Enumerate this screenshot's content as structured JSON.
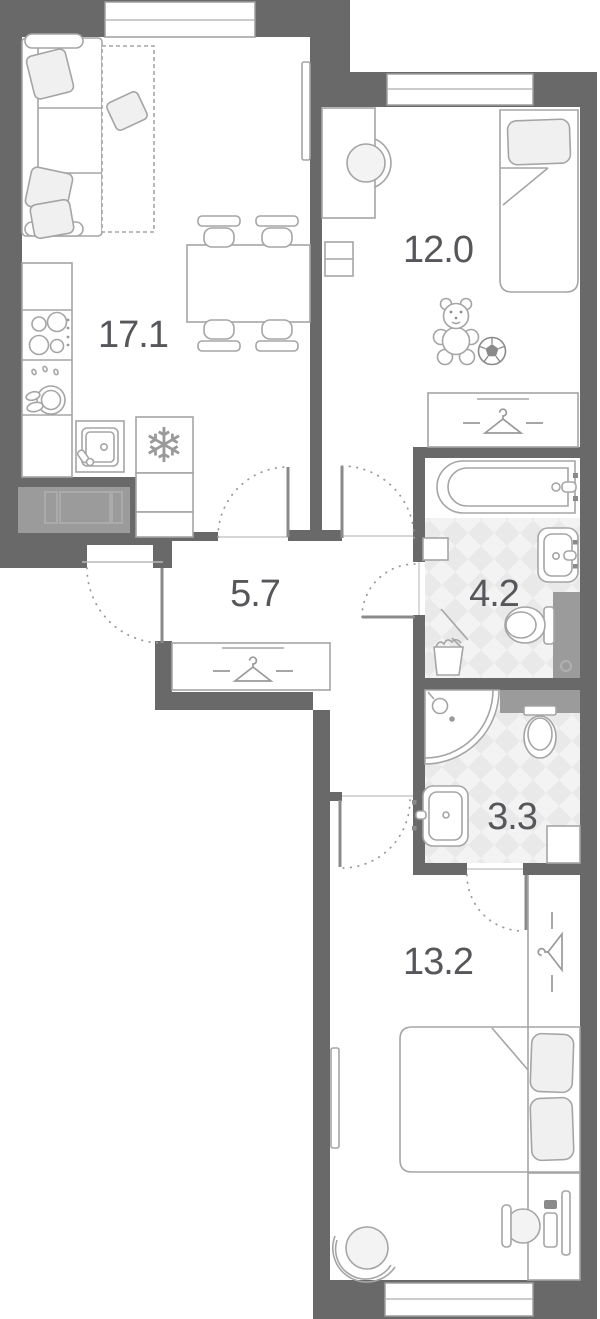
{
  "plan": {
    "title": "apartment-floor-plan",
    "rooms": [
      {
        "name": "living-room-kitchen",
        "area_label": "17.1"
      },
      {
        "name": "bedroom-small",
        "area_label": "12.0"
      },
      {
        "name": "hallway",
        "area_label": "5.7"
      },
      {
        "name": "bathroom",
        "area_label": "4.2"
      },
      {
        "name": "toilet-shower-room",
        "area_label": "3.3"
      },
      {
        "name": "bedroom-large",
        "area_label": "13.2"
      }
    ],
    "icons": {
      "snowflake": "❄"
    },
    "colors": {
      "wall": "#696969",
      "furniture_stroke": "#a5a5a5",
      "soft_fill": "#f0f0f0",
      "tile_base": "#f3f3f3",
      "tile_diamond": "#e9e9e9",
      "shaft_gray": "#9b9b9b",
      "label_text": "#56575a"
    }
  }
}
